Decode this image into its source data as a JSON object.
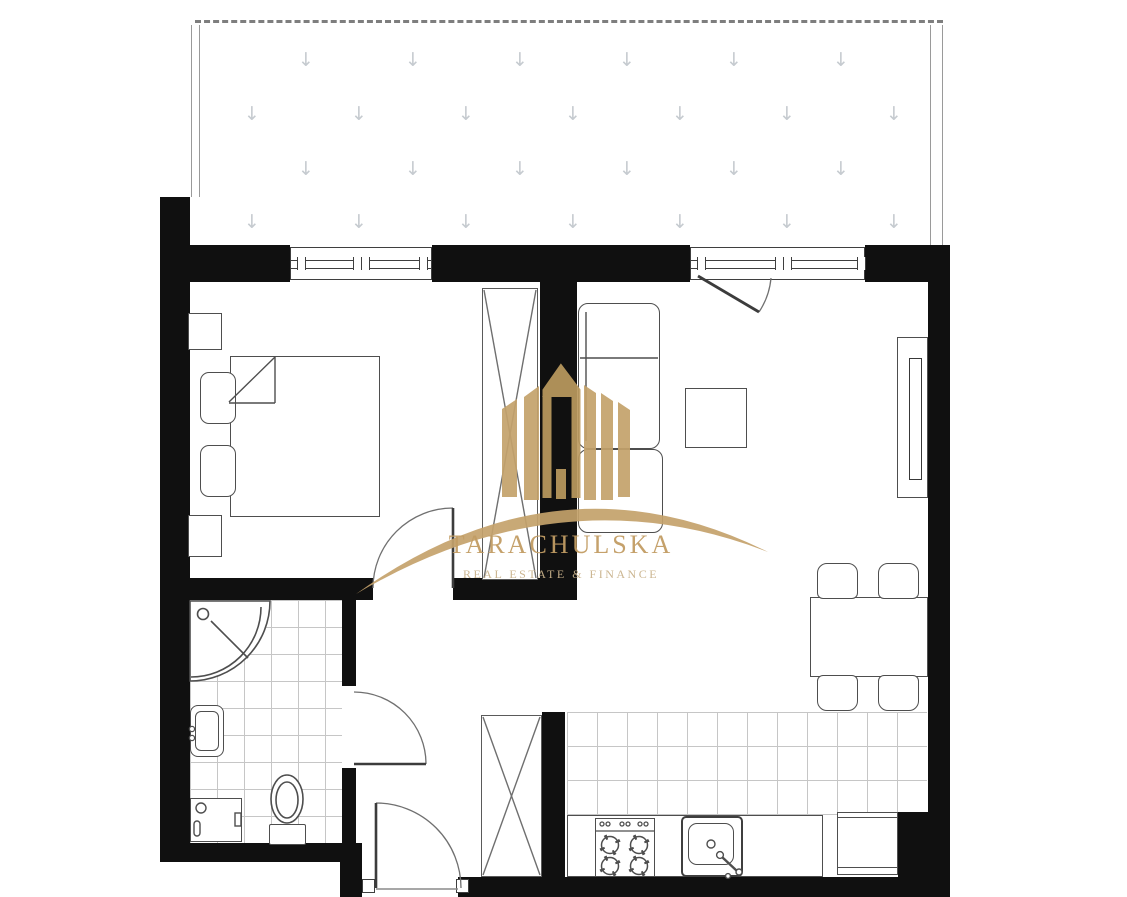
{
  "watermark": {
    "brand": "TARACHULSKA",
    "tagline": "REAL ESTATE & FINANCE",
    "gold": "#c4a26b",
    "gold_dark": "#bb9a5f",
    "gold_text": "#c29d64",
    "gold_text_light": "#c9b28b"
  },
  "plan": {
    "type": "apartment-floor-plan",
    "colors": {
      "wall": "#101010",
      "furniture_line": "#4e4e4e",
      "window_line": "#3f3f3f",
      "tile_line": "#c6c6c6",
      "balcony_arrow": "#c6cbd0",
      "door_arc": "#707070"
    },
    "balcony": {
      "pattern": "down-arrow-grid",
      "rows": 4
    },
    "rooms": [
      "balcony",
      "bedroom",
      "living-room",
      "kitchen",
      "bathroom",
      "hallway"
    ],
    "fixtures": {
      "balcony": [
        "decking-arrow-pattern"
      ],
      "bedroom": [
        "double-bed",
        "pillow",
        "pillow",
        "nightstand",
        "nightstand",
        "wardrobe-x",
        "window",
        "door"
      ],
      "living-room": [
        "sofa",
        "coffee-table",
        "tv-unit",
        "dining-table",
        "chair",
        "chair",
        "chair",
        "chair",
        "balcony-door",
        "window"
      ],
      "kitchen": [
        "counter",
        "stove",
        "sink",
        "fridge",
        "tiled-floor"
      ],
      "bathroom": [
        "corner-shower",
        "washbasin",
        "washing-machine",
        "toilet",
        "tiled-floor",
        "door"
      ],
      "hallway": [
        "wardrobe-x",
        "entrance-door"
      ]
    }
  }
}
